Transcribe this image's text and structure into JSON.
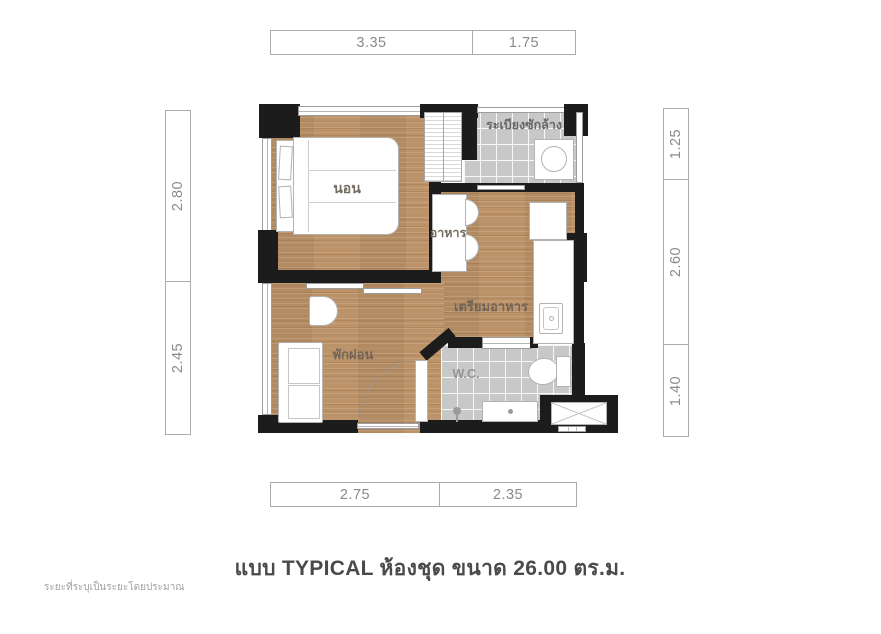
{
  "floor_plan": {
    "caption": "แบบ TYPICAL ห้องชุด ขนาด 26.00 ตร.ม.",
    "footnote": "ระยะที่ระบุเป็นระยะโดยประมาณ",
    "rooms": {
      "bedroom": "นอน",
      "laundry_balcony": "ระเบียงซักล้าง",
      "dining": "อาหาร",
      "kitchen": "เตรียมอาหาร",
      "living": "พักผ่อน",
      "wc": "W.C."
    },
    "dimensions": {
      "top": [
        "3.35",
        "1.75"
      ],
      "bottom": [
        "2.75",
        "2.35"
      ],
      "left": [
        "2.80",
        "2.45"
      ],
      "right": [
        "1.25",
        "2.60",
        "1.40"
      ]
    },
    "colors": {
      "wall": "#1c1c1c",
      "wood_floor": "#bc9268",
      "tile_floor": "#c8c8c8",
      "dimension_text": "#8a8a8a",
      "room_label_text": "#6b6155",
      "caption_text": "#4a4a4a"
    }
  }
}
